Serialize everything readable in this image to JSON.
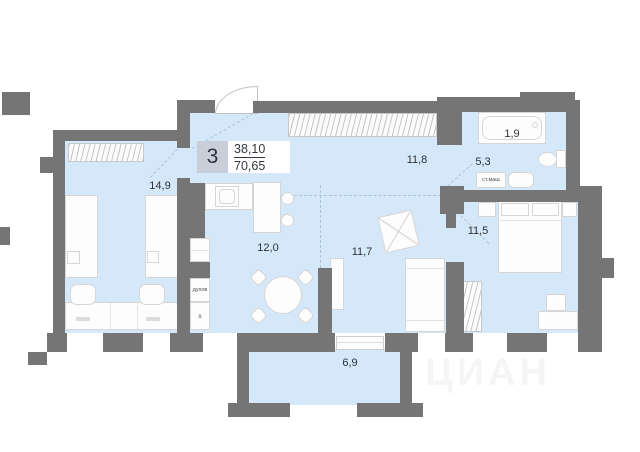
{
  "legend": {
    "room_count": "3",
    "area_upper": "38,10",
    "area_lower": "70,65"
  },
  "rooms": {
    "children_bedroom": "14,9",
    "kitchen": "12,0",
    "living_room": "11,7",
    "hallway": "11,8",
    "master_bedroom": "11,5",
    "bath_zone": "1,9",
    "bathroom": "5,3",
    "balcony": "6,9"
  },
  "labels": {
    "oven": "духов",
    "appliance": "х",
    "washing_machine": "ст.маш"
  },
  "watermark": "ЦИАН",
  "colors": {
    "wall": "#757575",
    "floor": "#d4e8fa"
  }
}
